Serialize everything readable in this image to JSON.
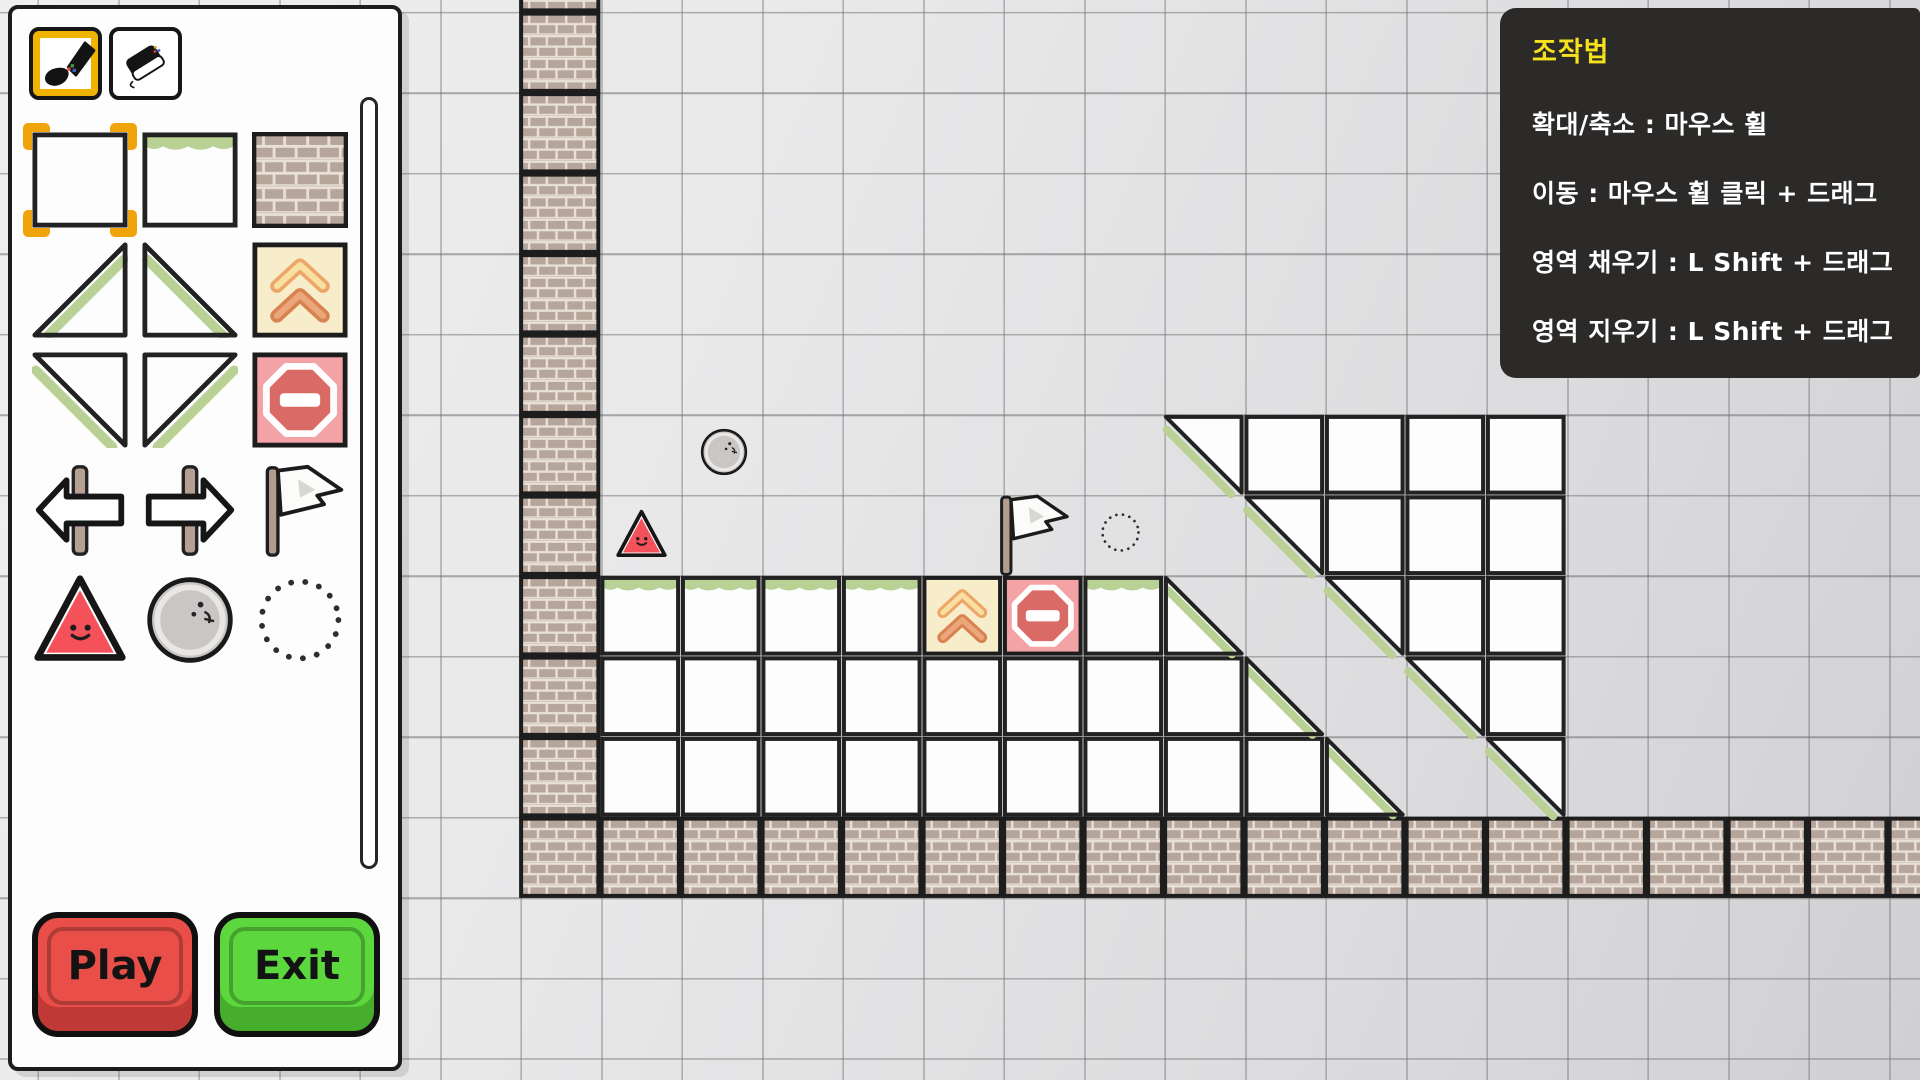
{
  "editor": {
    "tools": [
      {
        "name": "brush",
        "selected": true
      },
      {
        "name": "eraser",
        "selected": false
      }
    ],
    "palette": [
      "tile-blank",
      "tile-grass",
      "tile-brick",
      "slope-asc",
      "slope-desc",
      "pad",
      "slope-inv-desc",
      "slope-inv-asc",
      "stop",
      "arrow-left",
      "arrow-right",
      "flag",
      "watermelon",
      "rock",
      "dotted-circle"
    ],
    "palette_selected": "tile-blank",
    "buttons": {
      "play": "Play",
      "exit": "Exit"
    }
  },
  "help": {
    "title": "조작법",
    "lines": [
      "확대/축소 : 마우스 휠",
      "이동 : 마우스 휠 클릭 + 드래그",
      "영역 채우기 : L Shift + 드래그",
      "영역 지우기 : L Shift + 드래그"
    ]
  },
  "colors": {
    "accent_yellow": "#f0b400",
    "selection_orange": "#f0a30a",
    "play_red": "#e94f48",
    "exit_green": "#5cd83e",
    "grass_green": "#b9d194",
    "pad_cream": "#f8edca",
    "pad_orange": "#eda667",
    "stop_pink": "#f3a2a6",
    "stop_red": "#d96a66",
    "brick_taupe": "#b5a59b",
    "help_bg": "#2b2a28",
    "help_title_yellow": "#f6e11d"
  },
  "level": {
    "grid": {
      "cell": 80.5,
      "ox": 439,
      "oy": 12
    },
    "brick_column": {
      "col": 1,
      "row_first": -1,
      "row_last": 9
    },
    "brick_floor": {
      "row": 10,
      "col_first": 1,
      "col_last": 18
    },
    "grass_cells": [
      [
        2,
        7
      ],
      [
        3,
        7
      ],
      [
        4,
        7
      ],
      [
        5,
        7
      ],
      [
        8,
        7
      ]
    ],
    "pad_cells": [
      [
        6,
        7
      ]
    ],
    "stop_cells": [
      [
        7,
        7
      ]
    ],
    "white_cells": [
      [
        2,
        8
      ],
      [
        3,
        8
      ],
      [
        4,
        8
      ],
      [
        5,
        8
      ],
      [
        6,
        8
      ],
      [
        7,
        8
      ],
      [
        8,
        8
      ],
      [
        9,
        8
      ],
      [
        13,
        8
      ],
      [
        2,
        9
      ],
      [
        3,
        9
      ],
      [
        4,
        9
      ],
      [
        5,
        9
      ],
      [
        6,
        9
      ],
      [
        7,
        9
      ],
      [
        8,
        9
      ],
      [
        9,
        9
      ],
      [
        10,
        9
      ],
      [
        10,
        5
      ],
      [
        11,
        5
      ],
      [
        12,
        5
      ],
      [
        13,
        5
      ],
      [
        11,
        6
      ],
      [
        12,
        6
      ],
      [
        13,
        6
      ],
      [
        12,
        7
      ],
      [
        13,
        7
      ]
    ],
    "slope_cells_solid_below": [
      [
        9,
        7
      ],
      [
        10,
        8
      ],
      [
        11,
        9
      ]
    ],
    "slope_cells_solid_above": [
      [
        9,
        5
      ],
      [
        10,
        6
      ],
      [
        11,
        7
      ],
      [
        12,
        8
      ],
      [
        13,
        9
      ]
    ],
    "objects": [
      {
        "type": "rock",
        "x": 698,
        "y": 426,
        "scale": 0.52
      },
      {
        "type": "watermelon",
        "x": 615,
        "y": 508,
        "scale": 0.53
      },
      {
        "type": "flag",
        "x": 988,
        "y": 492,
        "scale": 0.85
      },
      {
        "type": "dotted-circle",
        "x": 1098,
        "y": 510,
        "scale": 0.45
      }
    ]
  }
}
